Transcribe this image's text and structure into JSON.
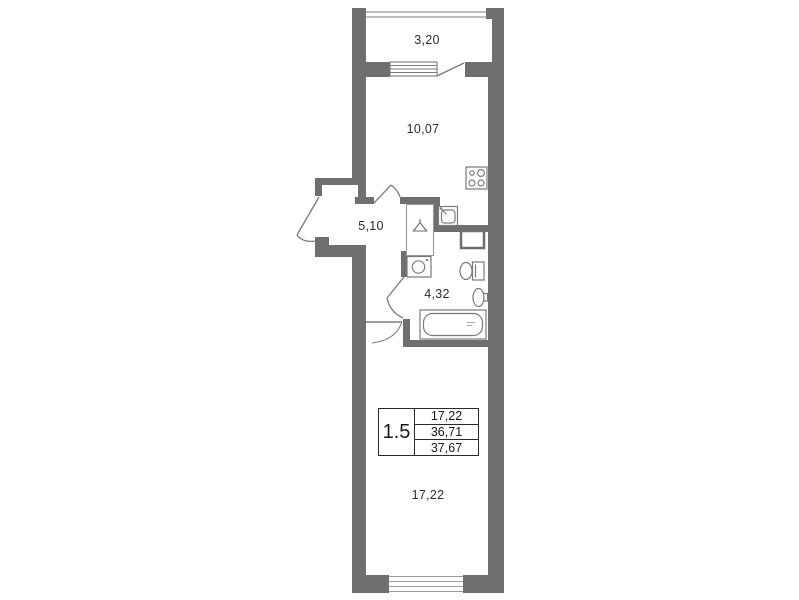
{
  "plan": {
    "title": "apartment-floor-plan",
    "rooms": [
      {
        "id": "balcony",
        "area": "3,20"
      },
      {
        "id": "kitchen-living",
        "area": "10,07"
      },
      {
        "id": "hall",
        "area": "5,10"
      },
      {
        "id": "bathroom",
        "area": "4,32"
      },
      {
        "id": "living-room",
        "area": "17,22"
      }
    ],
    "info_box": {
      "type": "1.5",
      "values": [
        "17,22",
        "36,71",
        "37,67"
      ]
    },
    "fixtures": [
      "stove",
      "kitchen-sink",
      "wardrobe",
      "washing-machine",
      "toilet",
      "wash-basin",
      "bathtub"
    ],
    "colors": {
      "wall": "#6f6f6f",
      "line": "#8f8f8f",
      "fixture": "#7a7a7a",
      "text": "#2b2b2b"
    }
  }
}
